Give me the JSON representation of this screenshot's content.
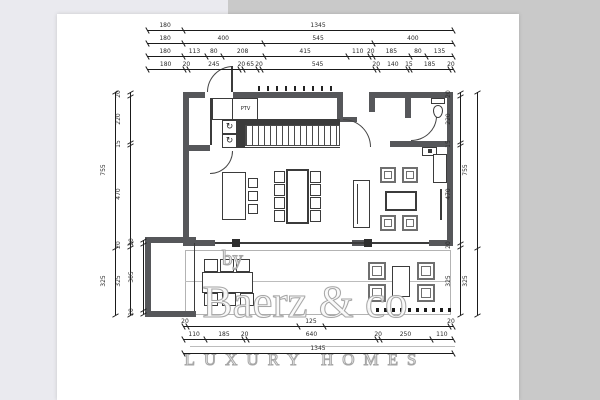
{
  "watermark": {
    "by": "by",
    "brand": "Baerz & co",
    "tagline": "LUXURY HOMES"
  },
  "plan": {
    "closet_label": "PTV",
    "appliance_icon": "↻"
  },
  "colors": {
    "wall": "#56575a",
    "line": "#3b3b3b",
    "background": "#c9c9c9",
    "left_margin": "#eaeaef",
    "sheet": "#ffffff",
    "watermark_outline": "#a6a6a6"
  },
  "dimensions": {
    "top_rows": [
      [
        "180",
        "1345"
      ],
      [
        "180",
        "400",
        "545",
        "400"
      ],
      [
        "180",
        "113",
        "80",
        "208",
        "415",
        "110",
        "20",
        "185",
        "80",
        "135"
      ],
      [
        "180",
        "20",
        "245",
        "20",
        "65",
        "20",
        "545",
        "20",
        "140",
        "15",
        "185",
        "20"
      ]
    ],
    "bottom_rows": [
      [
        "20",
        "",
        "125",
        "",
        "20"
      ],
      [
        "110",
        "185",
        "20",
        "640",
        "20",
        "250",
        "110"
      ],
      [
        "1345"
      ]
    ],
    "left_outer": [
      "755",
      "325"
    ],
    "left_inner": [
      "20",
      "220",
      "15",
      "470",
      "20",
      "325"
    ],
    "balcony": [
      "20",
      "305",
      "20"
    ],
    "right_inner": [
      "20",
      "220",
      "15",
      "470",
      "20",
      "325"
    ],
    "right_outer": [
      "755",
      "325"
    ]
  }
}
